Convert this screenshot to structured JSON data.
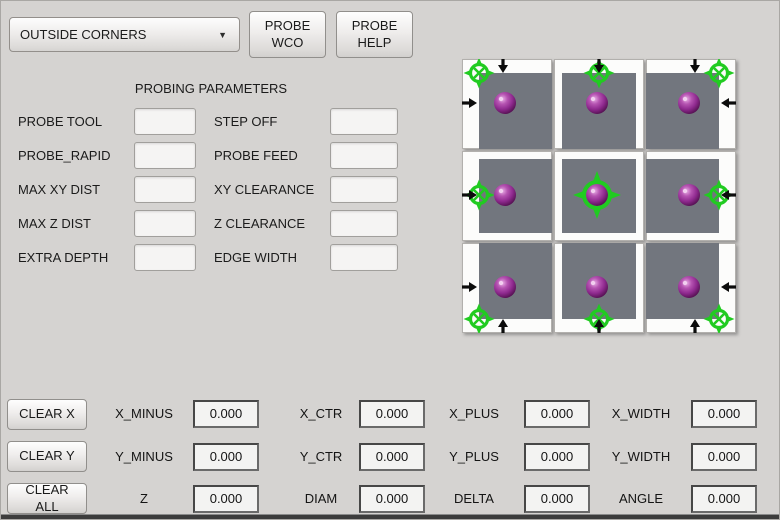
{
  "toolbar": {
    "mode_select_value": "OUTSIDE CORNERS",
    "caret_icon": "▼",
    "probe_wco_label": "PROBE\nWCO",
    "probe_help_label": "PROBE\nHELP"
  },
  "parameters": {
    "title": "PROBING PARAMETERS",
    "rows": [
      {
        "label1": "PROBE TOOL",
        "value1": "",
        "label2": "STEP OFF",
        "value2": ""
      },
      {
        "label1": "PROBE_RAPID",
        "value1": "",
        "label2": "PROBE FEED",
        "value2": ""
      },
      {
        "label1": "MAX XY DIST",
        "value1": "",
        "label2": "XY CLEARANCE",
        "value2": ""
      },
      {
        "label1": "MAX Z DIST",
        "value1": "",
        "label2": "Z CLEARANCE",
        "value2": ""
      },
      {
        "label1": "EXTRA DEPTH",
        "value1": "",
        "label2": "EDGE WIDTH",
        "value2": ""
      }
    ]
  },
  "probe_grid": {
    "colors": {
      "marker": "#21cb21",
      "square": "#72767e",
      "arrow": "#0c0c0c"
    },
    "cells": [
      {
        "name": "probe-outside-corner-top-left",
        "probe_point": "top-left",
        "arrows": [
          "down",
          "right"
        ]
      },
      {
        "name": "probe-outside-edge-top",
        "probe_point": "top-center",
        "arrows": [
          "down"
        ]
      },
      {
        "name": "probe-outside-corner-top-right",
        "probe_point": "top-right",
        "arrows": [
          "down",
          "left"
        ]
      },
      {
        "name": "probe-outside-edge-left",
        "probe_point": "left-center",
        "arrows": [
          "right"
        ]
      },
      {
        "name": "probe-center",
        "probe_point": "center",
        "arrows": []
      },
      {
        "name": "probe-outside-edge-right",
        "probe_point": "right-center",
        "arrows": [
          "left"
        ]
      },
      {
        "name": "probe-outside-corner-bottom-left",
        "probe_point": "bottom-left",
        "arrows": [
          "right",
          "up"
        ]
      },
      {
        "name": "probe-outside-edge-bottom",
        "probe_point": "bottom-center",
        "arrows": [
          "up"
        ]
      },
      {
        "name": "probe-outside-corner-bottom-right",
        "probe_point": "bottom-right",
        "arrows": [
          "left",
          "up"
        ]
      }
    ]
  },
  "results": {
    "buttons": [
      {
        "label": "CLEAR X"
      },
      {
        "label": "CLEAR Y"
      },
      {
        "label": "CLEAR ALL"
      }
    ],
    "rows": [
      {
        "cells": [
          {
            "label": "X_MINUS",
            "value": "0.000"
          },
          {
            "label": "X_CTR",
            "value": "0.000"
          },
          {
            "label": "X_PLUS",
            "value": "0.000"
          },
          {
            "label": "X_WIDTH",
            "value": "0.000"
          }
        ]
      },
      {
        "cells": [
          {
            "label": "Y_MINUS",
            "value": "0.000"
          },
          {
            "label": "Y_CTR",
            "value": "0.000"
          },
          {
            "label": "Y_PLUS",
            "value": "0.000"
          },
          {
            "label": "Y_WIDTH",
            "value": "0.000"
          }
        ]
      },
      {
        "cells": [
          {
            "label": "Z",
            "value": "0.000"
          },
          {
            "label": "DIAM",
            "value": "0.000"
          },
          {
            "label": "DELTA",
            "value": "0.000"
          },
          {
            "label": "ANGLE",
            "value": "0.000"
          }
        ]
      }
    ]
  }
}
